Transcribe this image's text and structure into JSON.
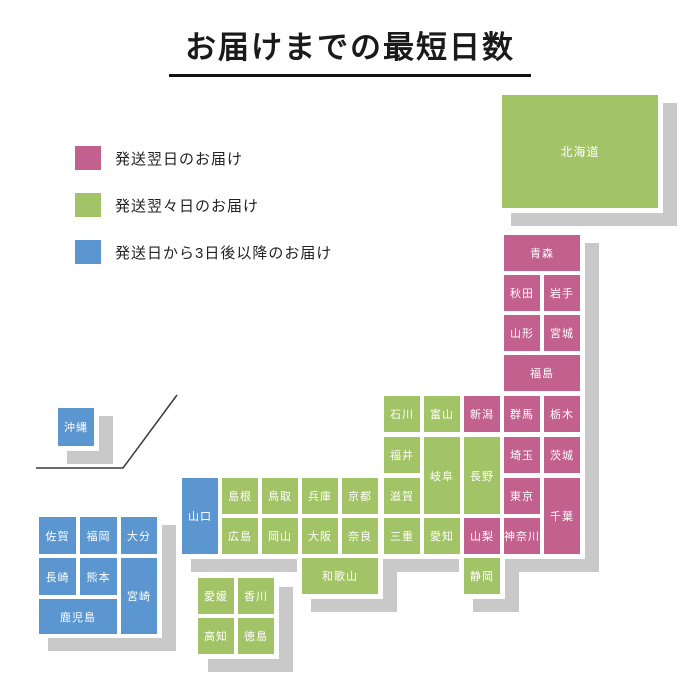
{
  "title": "お届けまでの最短日数",
  "legend": {
    "items": [
      {
        "label": "発送翌日のお届け",
        "category": "next_day"
      },
      {
        "label": "発送翌々日のお届け",
        "category": "two_days"
      },
      {
        "label": "発送日から3日後以降のお届け",
        "category": "three_plus_days"
      }
    ]
  },
  "colors": {
    "next_day": "#c2618d",
    "two_days": "#a3c367",
    "three_plus_days": "#5b96d0",
    "shadow": "#c9c9c9",
    "island_plate": "#ffffff",
    "box_text": "#ffffff",
    "title_text": "#1a1a1a"
  },
  "divider_line": {
    "points": "36,468 123,468 177,395"
  },
  "map": {
    "shadow_offset": {
      "dx": 14,
      "dy": 13
    },
    "islands": [
      {
        "name": "hokkaido",
        "x": 497,
        "y": 90,
        "w": 166,
        "h": 123
      },
      {
        "name": "tohoku-kanto",
        "x": 499,
        "y": 230,
        "w": 86,
        "h": 329
      },
      {
        "name": "chubu",
        "x": 379,
        "y": 391,
        "w": 126,
        "h": 168
      },
      {
        "name": "kansai-chugoku",
        "x": 177,
        "y": 473,
        "w": 206,
        "h": 86
      },
      {
        "name": "wakayama",
        "x": 297,
        "y": 552,
        "w": 86,
        "h": 47
      },
      {
        "name": "shizuoka",
        "x": 459,
        "y": 553,
        "w": 46,
        "h": 46
      },
      {
        "name": "kyushu",
        "x": 34,
        "y": 512,
        "w": 128,
        "h": 126
      },
      {
        "name": "shikoku",
        "x": 194,
        "y": 574,
        "w": 85,
        "h": 85
      },
      {
        "name": "okinawa",
        "x": 53,
        "y": 403,
        "w": 46,
        "h": 48
      }
    ],
    "prefectures": [
      {
        "name": "北海道",
        "category": "two_days",
        "x": 502,
        "y": 95,
        "w": 156,
        "h": 113
      },
      {
        "name": "青森",
        "category": "next_day",
        "x": 504,
        "y": 235,
        "w": 76,
        "h": 36
      },
      {
        "name": "秋田",
        "category": "next_day",
        "x": 504,
        "y": 275,
        "w": 36,
        "h": 36
      },
      {
        "name": "岩手",
        "category": "next_day",
        "x": 544,
        "y": 275,
        "w": 36,
        "h": 36
      },
      {
        "name": "山形",
        "category": "next_day",
        "x": 504,
        "y": 315,
        "w": 36,
        "h": 36
      },
      {
        "name": "宮城",
        "category": "next_day",
        "x": 544,
        "y": 315,
        "w": 36,
        "h": 36
      },
      {
        "name": "福島",
        "category": "next_day",
        "x": 504,
        "y": 355,
        "w": 76,
        "h": 36
      },
      {
        "name": "石川",
        "category": "two_days",
        "x": 384,
        "y": 396,
        "w": 36,
        "h": 36
      },
      {
        "name": "富山",
        "category": "two_days",
        "x": 424,
        "y": 396,
        "w": 36,
        "h": 36
      },
      {
        "name": "新潟",
        "category": "next_day",
        "x": 464,
        "y": 396,
        "w": 36,
        "h": 36
      },
      {
        "name": "群馬",
        "category": "next_day",
        "x": 504,
        "y": 396,
        "w": 36,
        "h": 36
      },
      {
        "name": "栃木",
        "category": "next_day",
        "x": 544,
        "y": 396,
        "w": 36,
        "h": 36
      },
      {
        "name": "福井",
        "category": "two_days",
        "x": 384,
        "y": 437,
        "w": 36,
        "h": 36
      },
      {
        "name": "岐阜",
        "category": "two_days",
        "x": 424,
        "y": 437,
        "w": 36,
        "h": 77
      },
      {
        "name": "長野",
        "category": "two_days",
        "x": 464,
        "y": 437,
        "w": 36,
        "h": 77
      },
      {
        "name": "埼玉",
        "category": "next_day",
        "x": 504,
        "y": 437,
        "w": 36,
        "h": 36
      },
      {
        "name": "茨城",
        "category": "next_day",
        "x": 544,
        "y": 437,
        "w": 36,
        "h": 36
      },
      {
        "name": "山口",
        "category": "three_plus_days",
        "x": 182,
        "y": 478,
        "w": 36,
        "h": 76
      },
      {
        "name": "島根",
        "category": "two_days",
        "x": 222,
        "y": 478,
        "w": 36,
        "h": 36
      },
      {
        "name": "鳥取",
        "category": "two_days",
        "x": 262,
        "y": 478,
        "w": 36,
        "h": 36
      },
      {
        "name": "兵庫",
        "category": "two_days",
        "x": 302,
        "y": 478,
        "w": 36,
        "h": 36
      },
      {
        "name": "京都",
        "category": "two_days",
        "x": 342,
        "y": 478,
        "w": 36,
        "h": 36
      },
      {
        "name": "滋賀",
        "category": "two_days",
        "x": 384,
        "y": 478,
        "w": 36,
        "h": 36
      },
      {
        "name": "東京",
        "category": "next_day",
        "x": 504,
        "y": 478,
        "w": 36,
        "h": 36
      },
      {
        "name": "千葉",
        "category": "next_day",
        "x": 544,
        "y": 478,
        "w": 36,
        "h": 76
      },
      {
        "name": "広島",
        "category": "two_days",
        "x": 222,
        "y": 518,
        "w": 36,
        "h": 36
      },
      {
        "name": "岡山",
        "category": "two_days",
        "x": 262,
        "y": 518,
        "w": 36,
        "h": 36
      },
      {
        "name": "大阪",
        "category": "two_days",
        "x": 302,
        "y": 518,
        "w": 36,
        "h": 36
      },
      {
        "name": "奈良",
        "category": "two_days",
        "x": 342,
        "y": 518,
        "w": 36,
        "h": 36
      },
      {
        "name": "三重",
        "category": "two_days",
        "x": 384,
        "y": 518,
        "w": 36,
        "h": 36
      },
      {
        "name": "愛知",
        "category": "two_days",
        "x": 424,
        "y": 518,
        "w": 36,
        "h": 36
      },
      {
        "name": "山梨",
        "category": "next_day",
        "x": 464,
        "y": 518,
        "w": 36,
        "h": 36
      },
      {
        "name": "神奈川",
        "category": "next_day",
        "x": 504,
        "y": 518,
        "w": 36,
        "h": 36
      },
      {
        "name": "和歌山",
        "category": "two_days",
        "x": 302,
        "y": 558,
        "w": 76,
        "h": 36
      },
      {
        "name": "静岡",
        "category": "two_days",
        "x": 464,
        "y": 558,
        "w": 36,
        "h": 36
      },
      {
        "name": "佐賀",
        "category": "three_plus_days",
        "x": 39,
        "y": 517,
        "w": 37,
        "h": 37
      },
      {
        "name": "福岡",
        "category": "three_plus_days",
        "x": 80,
        "y": 517,
        "w": 37,
        "h": 37
      },
      {
        "name": "大分",
        "category": "three_plus_days",
        "x": 121,
        "y": 517,
        "w": 36,
        "h": 37
      },
      {
        "name": "長崎",
        "category": "three_plus_days",
        "x": 39,
        "y": 558,
        "w": 37,
        "h": 37
      },
      {
        "name": "熊本",
        "category": "three_plus_days",
        "x": 80,
        "y": 558,
        "w": 37,
        "h": 37
      },
      {
        "name": "宮崎",
        "category": "three_plus_days",
        "x": 121,
        "y": 558,
        "w": 36,
        "h": 76
      },
      {
        "name": "鹿児島",
        "category": "three_plus_days",
        "x": 39,
        "y": 599,
        "w": 78,
        "h": 35
      },
      {
        "name": "愛媛",
        "category": "two_days",
        "x": 198,
        "y": 578,
        "w": 36,
        "h": 36
      },
      {
        "name": "香川",
        "category": "two_days",
        "x": 238,
        "y": 578,
        "w": 36,
        "h": 36
      },
      {
        "name": "高知",
        "category": "two_days",
        "x": 198,
        "y": 618,
        "w": 36,
        "h": 36
      },
      {
        "name": "徳島",
        "category": "two_days",
        "x": 238,
        "y": 618,
        "w": 36,
        "h": 36
      },
      {
        "name": "沖縄",
        "category": "three_plus_days",
        "x": 58,
        "y": 408,
        "w": 36,
        "h": 38
      }
    ]
  }
}
